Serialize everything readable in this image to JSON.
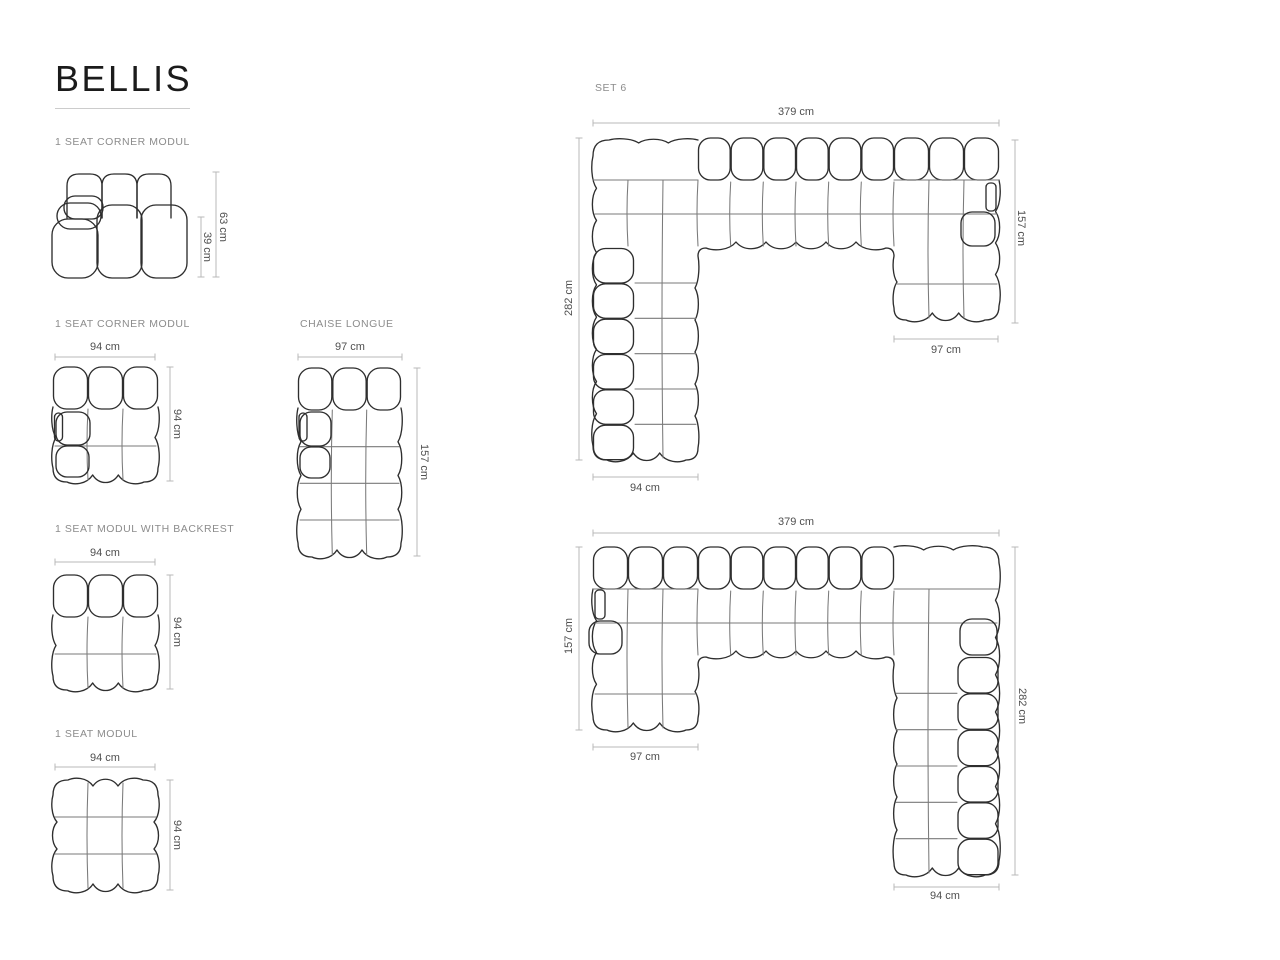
{
  "title": "BELLIS",
  "modules": {
    "corner_side": {
      "label": "1 SEAT CORNER MODUL",
      "height": "63 cm",
      "seat_height": "39 cm"
    },
    "corner_top": {
      "label": "1 SEAT CORNER MODUL",
      "width": "94 cm",
      "depth": "94 cm"
    },
    "chaise": {
      "label": "CHAISE LONGUE",
      "width": "97 cm",
      "depth": "157 cm"
    },
    "backrest_mod": {
      "label": "1 SEAT MODUL WITH BACKREST",
      "width": "94 cm",
      "depth": "94 cm"
    },
    "seat_mod": {
      "label": "1 SEAT MODUL",
      "width": "94 cm",
      "depth": "94 cm"
    }
  },
  "set6": {
    "label": "SET 6",
    "upper": {
      "total_width": "379 cm",
      "left_depth": "282 cm",
      "right_depth": "157 cm",
      "left_leg_width": "94 cm",
      "right_leg_width": "97 cm"
    },
    "lower": {
      "total_width": "379 cm",
      "left_depth": "157 cm",
      "right_depth": "282 cm",
      "left_leg_width": "97 cm",
      "right_leg_width": "94 cm"
    }
  },
  "colors": {
    "outline": "#2e2e2e",
    "inner_line": "#7a7a7a",
    "dim_line": "#b9b9b9",
    "dim_text": "#4f4f4f",
    "label_text": "#8c8c8c",
    "title_text": "#1b1b1b",
    "rule": "#cccccc",
    "background": "#ffffff"
  }
}
